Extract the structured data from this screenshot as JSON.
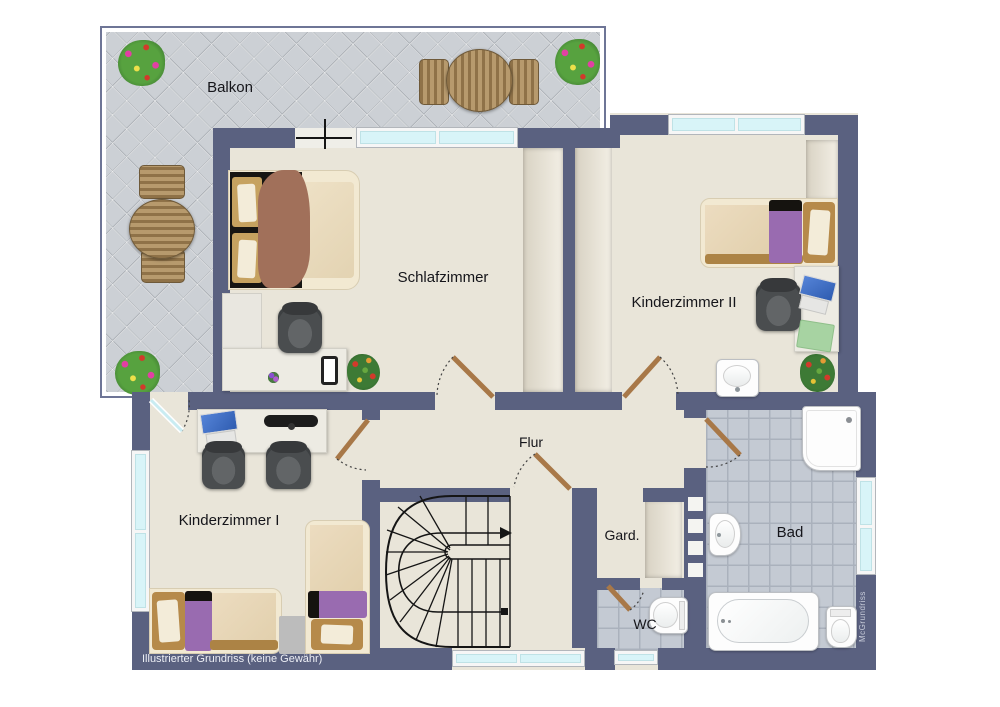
{
  "rooms": {
    "balcony": {
      "label": "Balkon"
    },
    "bedroom": {
      "label": "Schlafzimmer"
    },
    "kids_room_2": {
      "label": "Kinderzimmer II"
    },
    "kids_room_1": {
      "label": "Kinderzimmer I"
    },
    "hallway": {
      "label": "Flur"
    },
    "wardrobe": {
      "label": "Gard."
    },
    "wc": {
      "label": "WC"
    },
    "bathroom": {
      "label": "Bad"
    }
  },
  "footer": {
    "disclaimer": "Illustrierter Grundriss (keine Gewähr)"
  },
  "watermark": {
    "brand": "McGrundriss"
  },
  "colors": {
    "wall": "#5a6180",
    "floor": "#e9e5d9",
    "balcony_tile": "#ccd0d5",
    "bath_tile": "#c4cad3",
    "window_glass": "#d8f4f8",
    "door_leaf": "#a87848",
    "accent_purple": "#996bb0",
    "accent_blanket": "#a1705a"
  }
}
